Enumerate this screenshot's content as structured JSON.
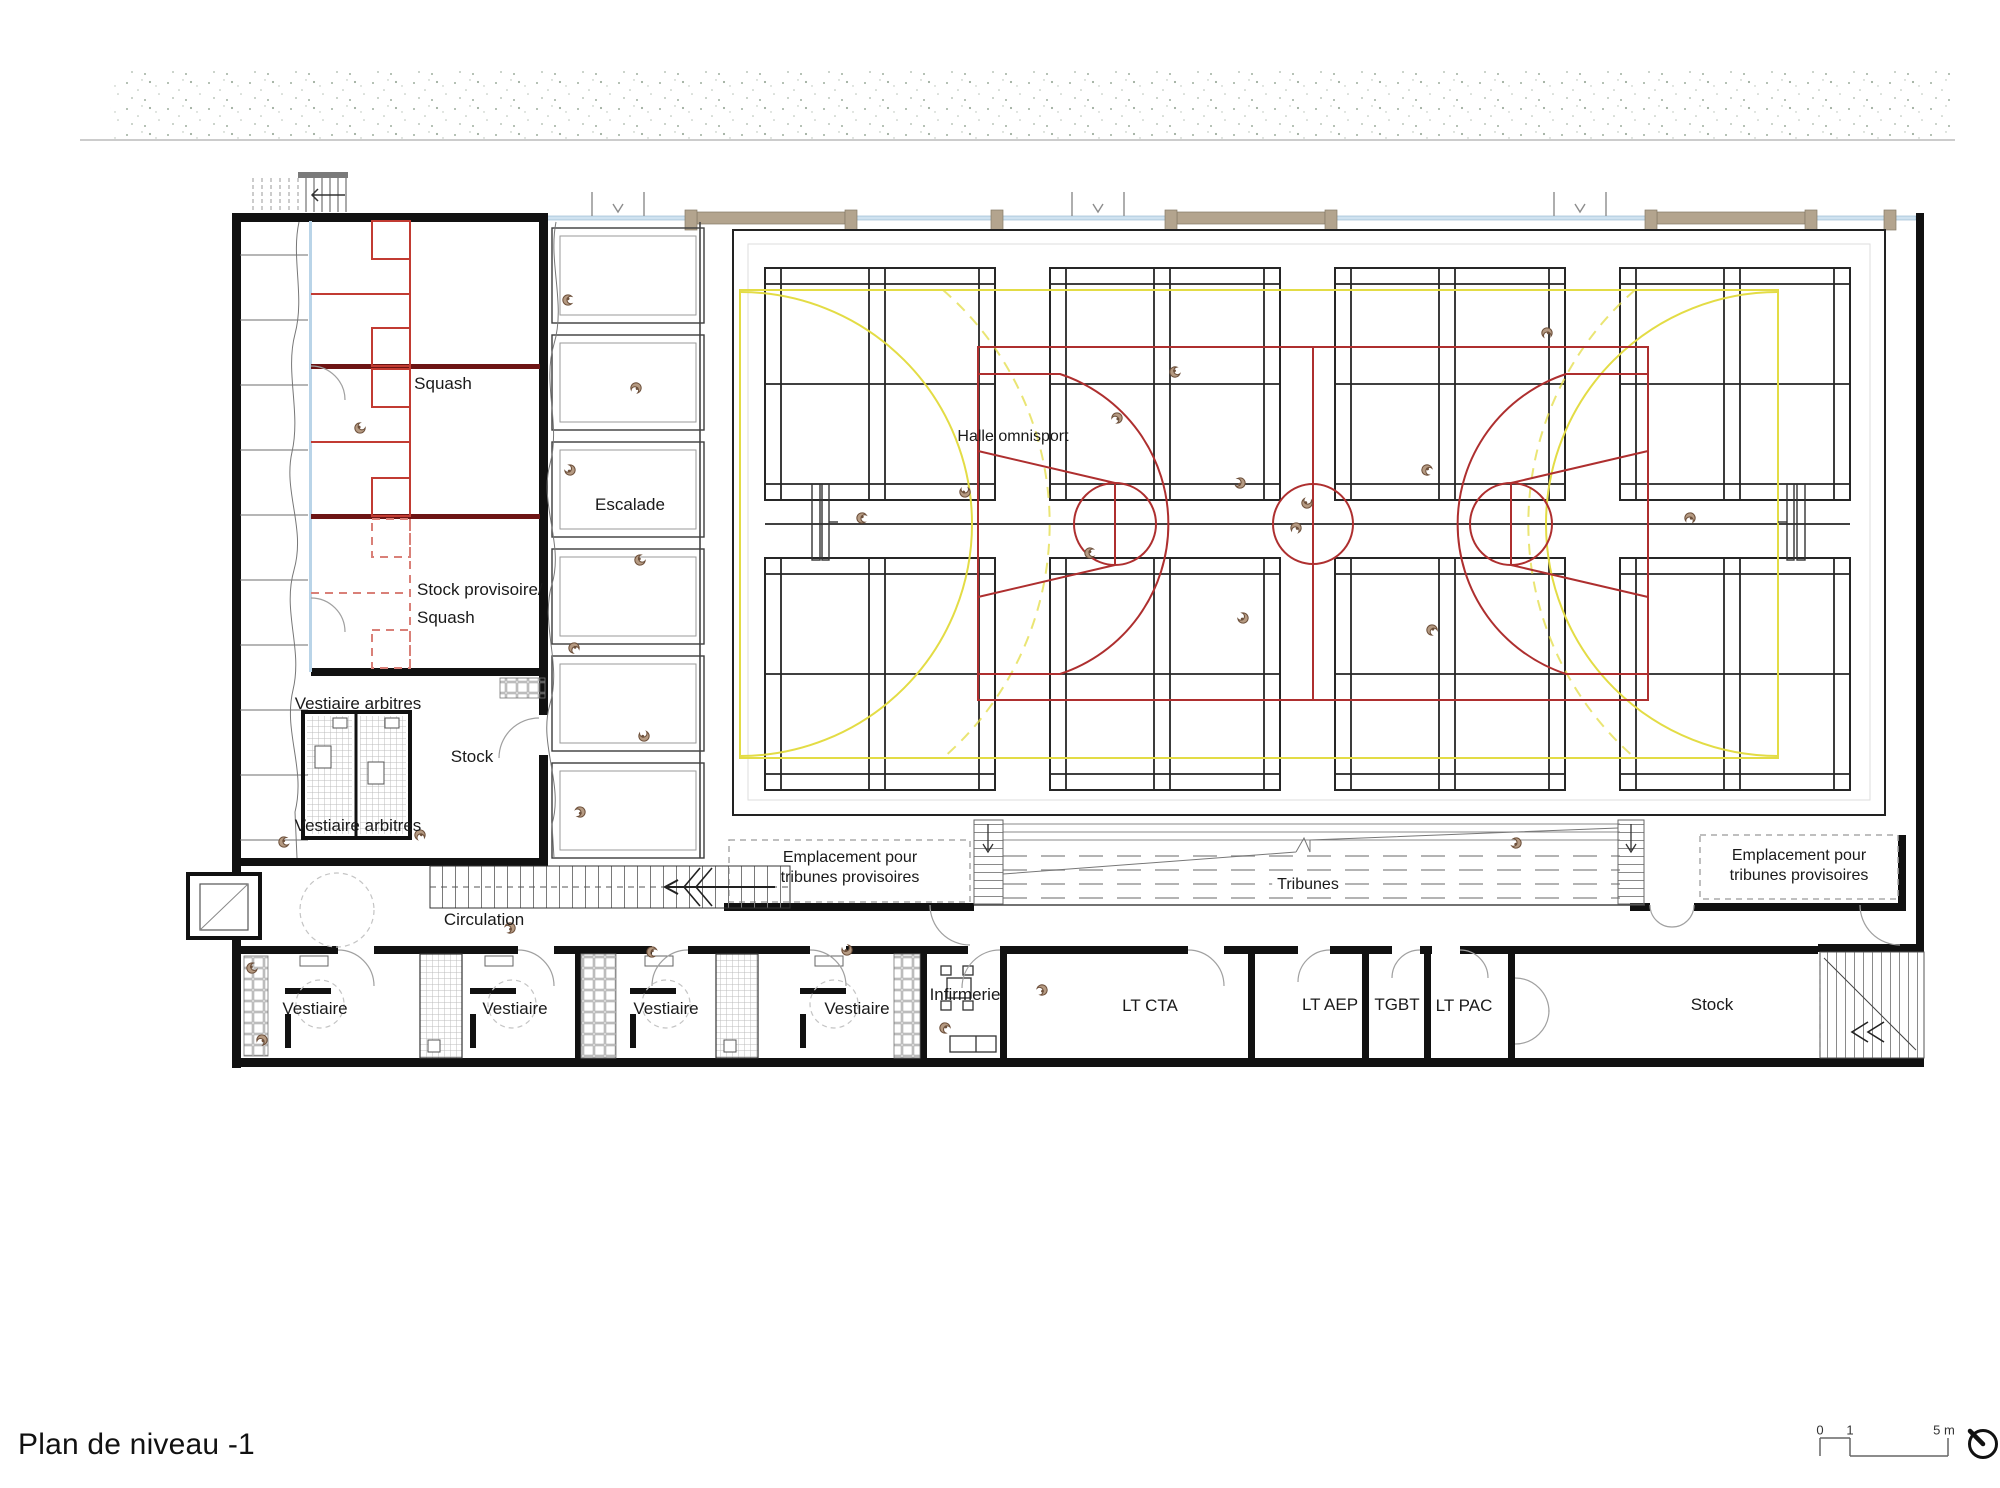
{
  "title": "Plan de niveau -1",
  "scale_bar": {
    "zero": "0",
    "one": "1",
    "five": "5 m"
  },
  "rooms": {
    "squash": "Squash",
    "stock_provisoire_line1": "Stock provisoire/",
    "stock_provisoire_line2": "Squash",
    "escalade": "Escalade",
    "vestiaire_arbitres": "Vestiaire arbitres",
    "stock_left": "Stock",
    "circulation": "Circulation",
    "halle": "Halle omnisport",
    "tribunes": "Tribunes",
    "emplacement_line1": "Emplacement pour",
    "emplacement_line2": "tribunes provisoires",
    "vestiaire": "Vestiaire",
    "infirmerie": "Infirmerie",
    "lt_cta": "LT CTA",
    "lt_aep": "LT AEP",
    "tgbt": "TGBT",
    "lt_pac": "LT PAC",
    "stock_right": "Stock"
  },
  "icons": {
    "floor_socket": "spiral floor-socket symbol",
    "north_arrow": "north direction indicator"
  },
  "colors": {
    "wall_black": "#111111",
    "squash_red": "#c23b32",
    "squash_wall_maroon": "#6d1414",
    "basket_red": "#ae2f2f",
    "handball_yellow": "#e3dc45",
    "glazing_blue": "#cfe2f0",
    "facade_beige": "#b3a48e",
    "socket_brown": "#b59a82"
  }
}
